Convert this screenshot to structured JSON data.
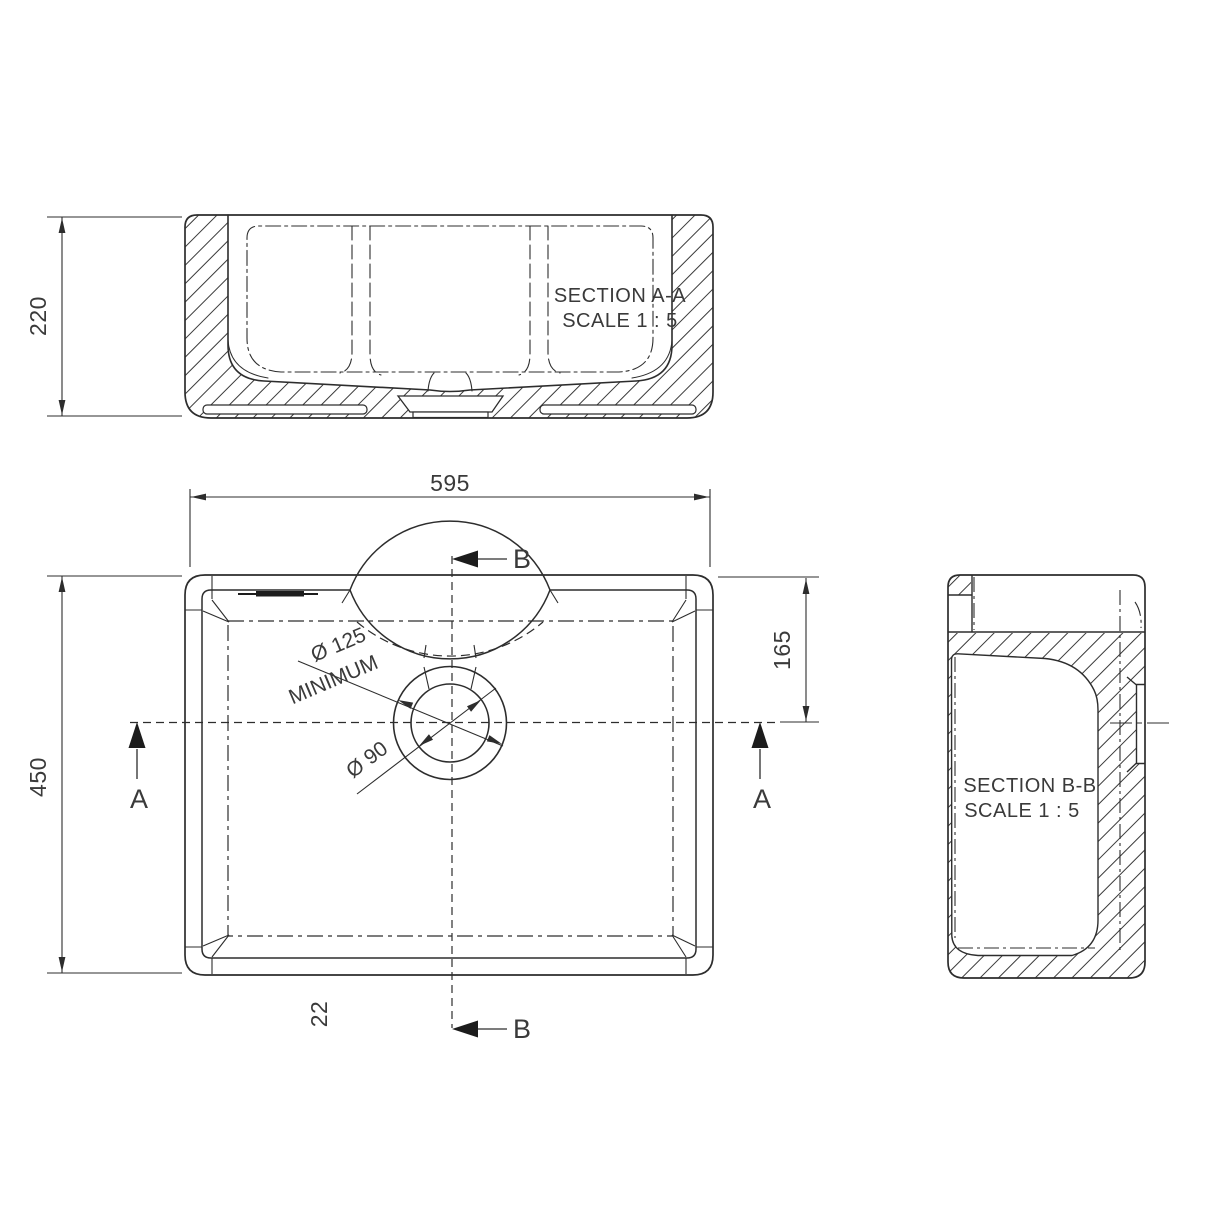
{
  "drawing": {
    "sections": {
      "aa": {
        "title": "SECTION A-A",
        "scale": "SCALE 1 : 5"
      },
      "bb": {
        "title": "SECTION B-B",
        "scale": "SCALE 1 : 5"
      }
    },
    "dimensions": {
      "overall_height": "220",
      "overall_width": "595",
      "overall_depth": "450",
      "drain_center_offset": "165",
      "rim_thickness": "22",
      "waste_min": "Ø 125",
      "waste_min_note": "MINIMUM",
      "waste_hole": "Ø 90"
    },
    "cut_labels": {
      "a": "A",
      "b": "B"
    },
    "colors": {
      "line": "#2d2d2d",
      "hatch": "#3a3a3a",
      "text": "#3a3a3a"
    }
  }
}
